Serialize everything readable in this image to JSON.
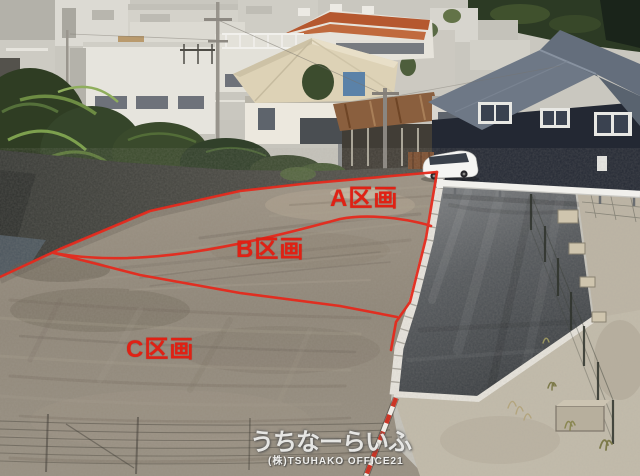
{
  "plots": [
    {
      "id": "A",
      "label": "A区画"
    },
    {
      "id": "B",
      "label": "B区画"
    },
    {
      "id": "C",
      "label": "C区画"
    }
  ],
  "watermark": {
    "site_name": "うちなーらいふ",
    "company": "(株)TSUHAKO OFFICE21"
  },
  "colors": {
    "plot_line_red": "#e52a1d",
    "plot_label_red": "#e02114",
    "watermark_white": "#ffffff",
    "dirt_field": "#938a7b",
    "asphalt_dark": "#3e4246",
    "curb_white": "#e9e6df",
    "navy_house": "#232833",
    "hill_green": "#2c3a24"
  }
}
